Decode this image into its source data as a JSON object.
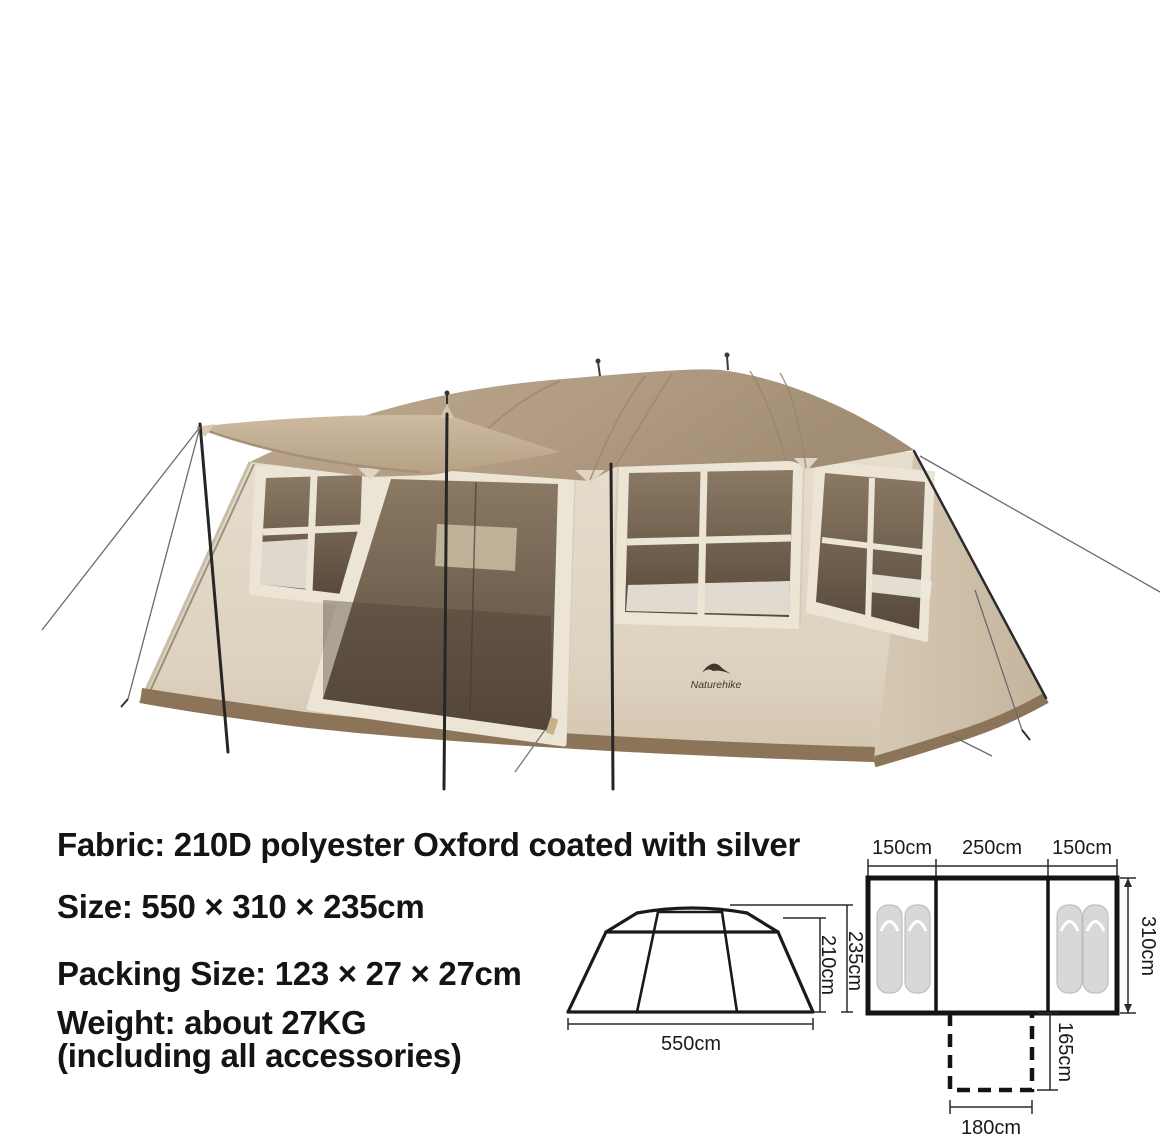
{
  "brand": "Naturehike",
  "specs": {
    "fabric": "Fabric: 210D polyester Oxford coated with silver",
    "size": "Size: 550 × 310 × 235cm",
    "packing_size": "Packing Size: 123 × 27 × 27cm",
    "weight": "Weight: about 27KG",
    "weight_note": "(including all accessories)"
  },
  "side_view_diagram": {
    "width": "550cm",
    "eave_height": "210cm",
    "peak_height": "235cm"
  },
  "floor_plan_diagram": {
    "left_room_width": "150cm",
    "center_room_width": "250cm",
    "right_room_width": "150cm",
    "depth": "310cm",
    "porch_depth": "165cm",
    "porch_width": "180cm"
  },
  "colors": {
    "roof_tan": "#b19b83",
    "wall_cream": "#e2d9c8",
    "mesh_brown": "#6e5f4e",
    "skirt_brown": "#8c7459",
    "diagram_line": "#1a1a1a",
    "text": "#141414"
  }
}
